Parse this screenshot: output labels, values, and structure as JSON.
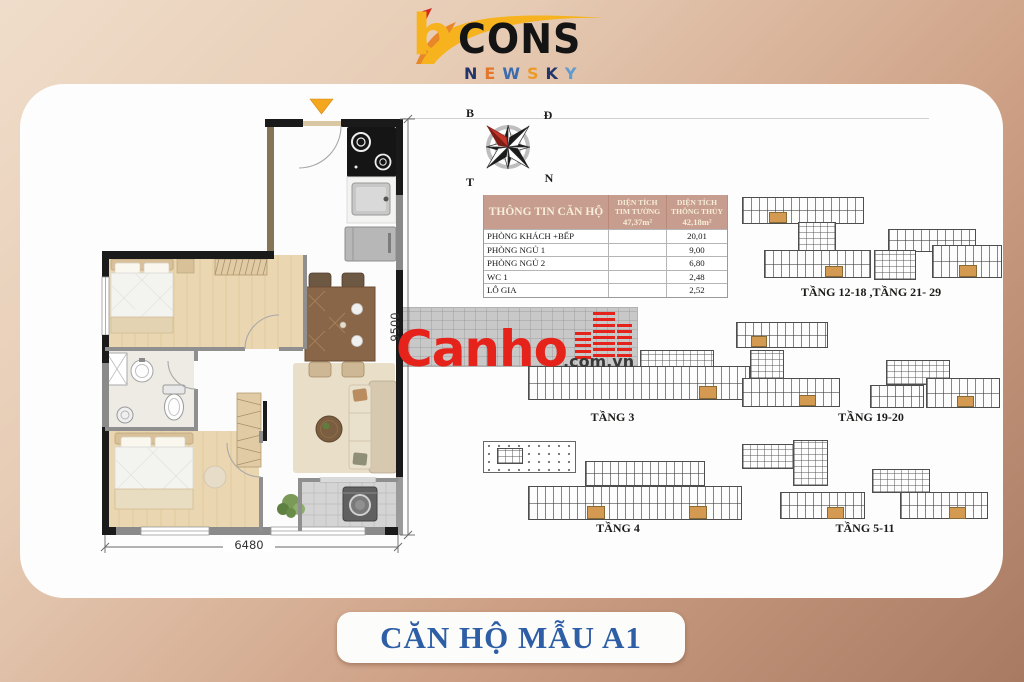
{
  "logo": {
    "b": "b",
    "cons": "CONS",
    "newsky": [
      "N",
      "E",
      "W",
      "S",
      "K",
      "Y"
    ]
  },
  "watermark": {
    "name": "Canho",
    "domain": ".com.vn"
  },
  "compass": {
    "north": "B",
    "east": "Đ",
    "west": "T",
    "south": "N"
  },
  "info_table": {
    "title": "THÔNG TIN CĂN HỘ",
    "col2_line1": "DIỆN TÍCH",
    "col2_line2": "TIM TƯỜNG",
    "col2_value": "47,37m²",
    "col3_line1": "DIỆN TÍCH",
    "col3_line2": "THÔNG THỦY",
    "col3_value": "42,18m²",
    "rows": [
      {
        "label": "PHÒNG KHÁCH +BẾP",
        "tim_tuong": "",
        "thong_thuy": "20,01"
      },
      {
        "label": "PHÒNG NGỦ 1",
        "tim_tuong": "",
        "thong_thuy": "9,00"
      },
      {
        "label": "PHÒNG NGỦ 2",
        "tim_tuong": "",
        "thong_thuy": "6,80"
      },
      {
        "label": "WC 1",
        "tim_tuong": "",
        "thong_thuy": "2,48"
      },
      {
        "label": "LÔ GIA",
        "tim_tuong": "",
        "thong_thuy": "2,52"
      }
    ]
  },
  "plan": {
    "width_label": "6480",
    "height_label": "9500"
  },
  "diagrams": {
    "g1": {
      "label": "TẦNG 12-18 ,TẦNG 21- 29"
    },
    "g2": {
      "label": "TẦNG 3"
    },
    "g3": {
      "label": "TẦNG 19-20"
    },
    "g4": {
      "label": "TẦNG 4"
    },
    "g5": {
      "label": "TẦNG 5-11"
    }
  },
  "banner": {
    "title": "CĂN HỘ MẪU A1"
  },
  "colors": {
    "accent_red": "#e5231b",
    "banner_blue": "#2e5ea6",
    "table_header_bg": "#c69d8e",
    "highlight_unit": "#d59a52",
    "entrance_arrow": "#f3a61e"
  }
}
